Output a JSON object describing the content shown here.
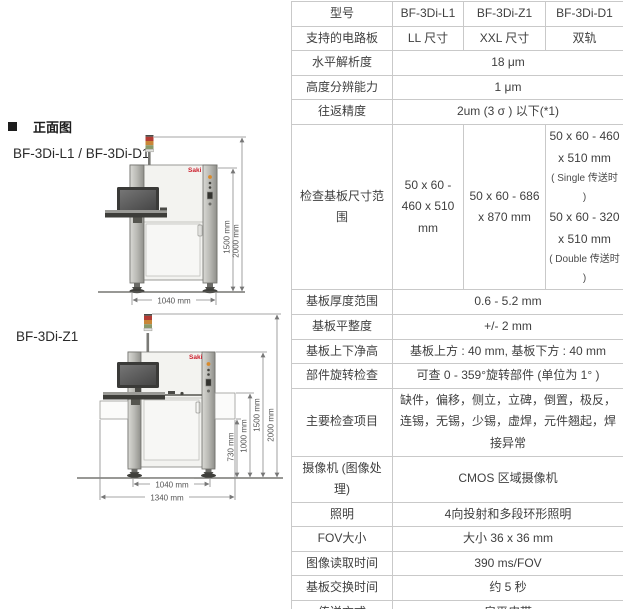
{
  "left_panel": {
    "section_title": "正面图",
    "machine1": {
      "label": "BF-3Di-L1 / BF-3Di-D1",
      "brand": "Saki",
      "dim_height_outer": "2000 mm",
      "dim_height_inner": "1500 mm",
      "dim_width": "1040 mm"
    },
    "machine2": {
      "label": "BF-3Di-Z1",
      "brand": "Saki",
      "dim_height_outer": "2000 mm",
      "dim_height_inner": "1500 mm",
      "dim_conveyor_top": "1000 mm",
      "dim_conveyor_bottom": "730 mm",
      "dim_width_inner": "1040 mm",
      "dim_width_outer": "1340 mm"
    }
  },
  "spec_table": {
    "rows": [
      {
        "label": "型号",
        "cells": [
          {
            "text": "BF-3Di-L1"
          },
          {
            "text": "BF-3Di-Z1"
          },
          {
            "text": "BF-3Di-D1"
          }
        ]
      },
      {
        "label": "支持的电路板",
        "cells": [
          {
            "text": "LL 尺寸"
          },
          {
            "text": "XXL 尺寸"
          },
          {
            "text": "双轨"
          }
        ]
      },
      {
        "label": "水平解析度",
        "cells": [
          {
            "text": "18 μm",
            "span": 3
          }
        ]
      },
      {
        "label": "高度分辨能力",
        "cells": [
          {
            "text": "1 μm",
            "span": 3
          }
        ]
      },
      {
        "label": "往返精度",
        "cells": [
          {
            "text": "2um (3 σ ) 以下(*1)",
            "span": 3
          }
        ]
      },
      {
        "label": "检查基板尺寸范围",
        "cells": [
          {
            "text": "50 x 60 - 460 x 510 mm"
          },
          {
            "text": "50 x 60 - 686 x 870 mm"
          },
          {
            "segments": [
              {
                "text": "50 x 60 - 460 x 510 mm"
              },
              {
                "text": "( Single 传送时 )",
                "small": true
              },
              {
                "text": "50 x 60 - 320 x 510 mm"
              },
              {
                "text": "( Double 传送时 )",
                "small": true
              }
            ]
          }
        ]
      },
      {
        "label": "基板厚度范围",
        "cells": [
          {
            "text": "0.6 - 5.2 mm",
            "span": 3
          }
        ]
      },
      {
        "label": "基板平整度",
        "cells": [
          {
            "text": "+/- 2 mm",
            "span": 3
          }
        ]
      },
      {
        "label": "基板上下净高",
        "cells": [
          {
            "text": "基板上方 : 40 mm, 基板下方 : 40 mm",
            "span": 3
          }
        ]
      },
      {
        "label": "部件旋转检查",
        "cells": [
          {
            "text": "可查 0 - 359°旋转部件 (单位为 1° )",
            "span": 3
          }
        ]
      },
      {
        "label": "主要检查项目",
        "cells": [
          {
            "text": "缺件，偏移，侧立，立碑，倒置，极反，连锡，无锡，少锡，虚焊，元件翘起，焊接异常",
            "span": 3
          }
        ]
      },
      {
        "label": "摄像机 (图像处理)",
        "cells": [
          {
            "text": "CMOS 区域摄像机",
            "span": 3
          }
        ]
      },
      {
        "label": "照明",
        "cells": [
          {
            "text": "4向投射和多段环形照明",
            "span": 3
          }
        ]
      },
      {
        "label": "FOV大小",
        "cells": [
          {
            "text": "大小 36 x 36 mm",
            "span": 3
          }
        ]
      },
      {
        "label": "图像读取时间",
        "cells": [
          {
            "text": "390 ms/FOV",
            "span": 3
          }
        ]
      },
      {
        "label": "基板交换时间",
        "cells": [
          {
            "text": "约 5 秒",
            "span": 3
          }
        ]
      },
      {
        "label": "传送方式",
        "cells": [
          {
            "text": "扁平皮带",
            "span": 3
          }
        ]
      }
    ]
  }
}
